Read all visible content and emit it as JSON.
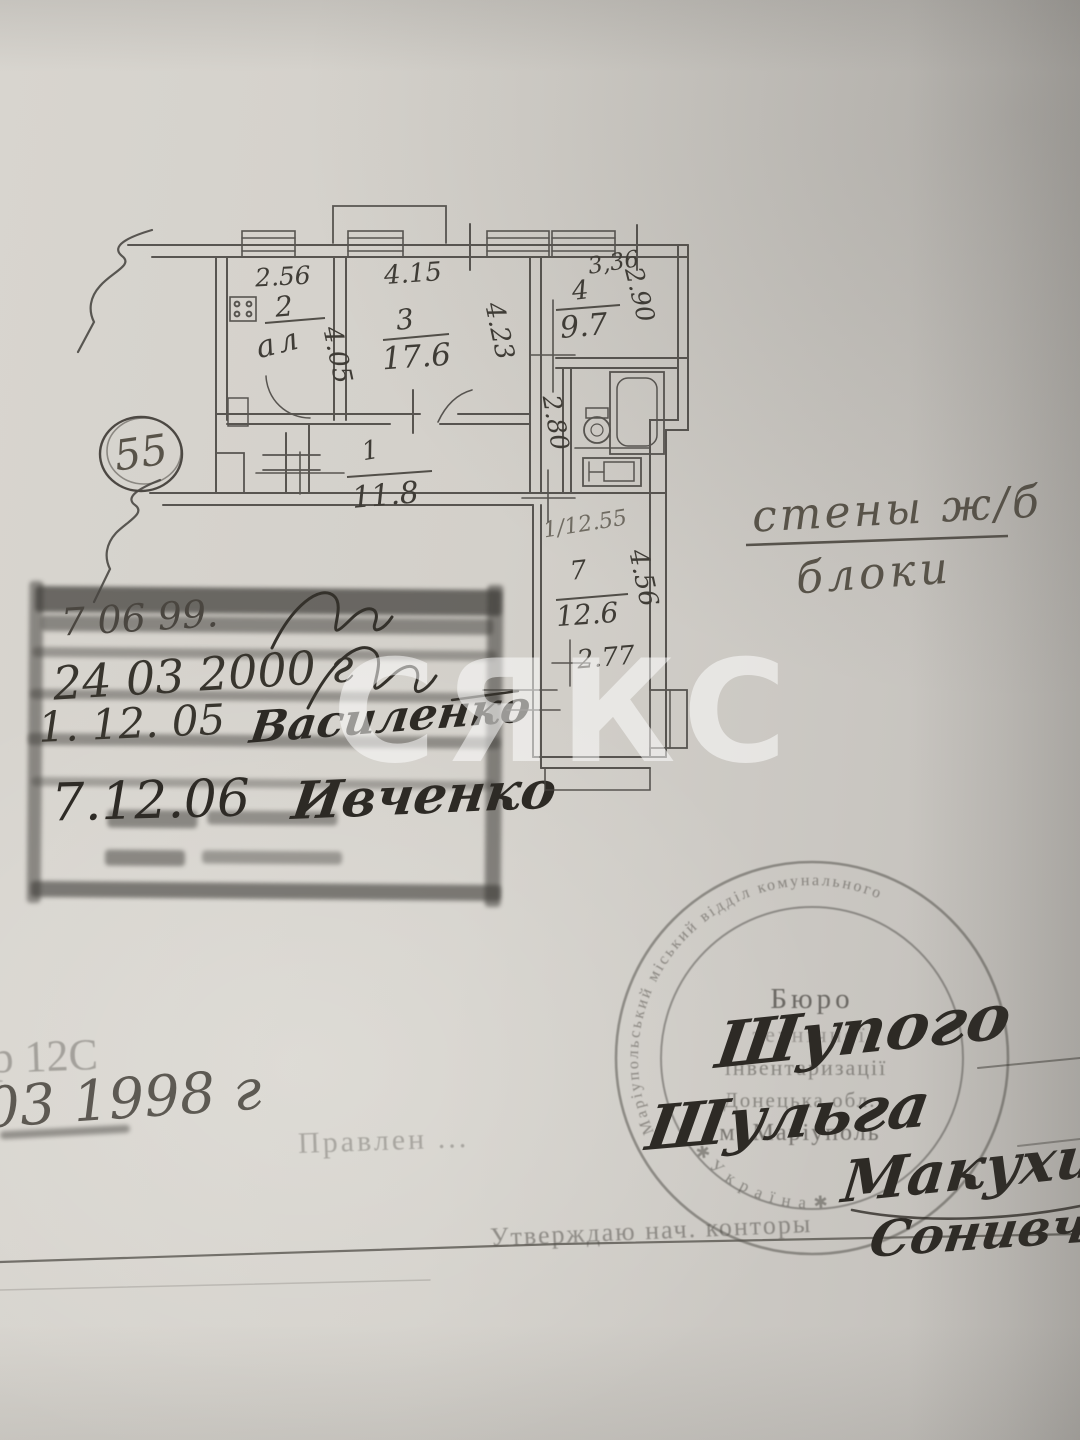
{
  "watermark": {
    "text": "СЯКС"
  },
  "plan": {
    "apartment_number": "55",
    "wall_note": {
      "top": "стены ж/б",
      "bottom": "блоки"
    },
    "bath_depth": "2.80",
    "rooms": {
      "r1": {
        "num": "1",
        "area": "11.8"
      },
      "r2": {
        "num": "2",
        "area_scribble": "ал",
        "width": "2.56",
        "depth": "4.05"
      },
      "r3": {
        "num": "3",
        "area": "17.6",
        "width": "4.15",
        "depth": "4.23"
      },
      "r4": {
        "num": "4",
        "area": "9.7",
        "width": "3,36",
        "depth": "2.90"
      },
      "r7": {
        "num": "7",
        "area": "12.6",
        "depth": "4.56",
        "width": "2.77",
        "pencil_note": "1/12.55"
      }
    }
  },
  "stamp_block": {
    "row1_date": "7  06  99.",
    "row2_date": "24 03 2000 г",
    "row3_date": "1. 12. 05",
    "row3_name": "Василенко",
    "row4_date": "7.12.06",
    "row4_name": "Ивченко"
  },
  "round_stamp": {
    "ring_top": "Маріупольський  міський  відділ  комунального",
    "ring_bottom": "✱  У к р а ї н а  ✱",
    "line1": "Бюро",
    "line2": "технічної",
    "line3": "інвентаризації",
    "line4": "Донецька обл.",
    "line5": "м. Маріуполь"
  },
  "signatures": {
    "sig1": "Шупого",
    "sig2": "Шульга",
    "sig3": "Макухина",
    "sig4": "Сонивчен"
  },
  "footer": {
    "faded_ref": "ар 12С",
    "date": "03 1998 г",
    "faded_word": "Правлен ...",
    "approval": "Утверждаю нач. конторы"
  }
}
